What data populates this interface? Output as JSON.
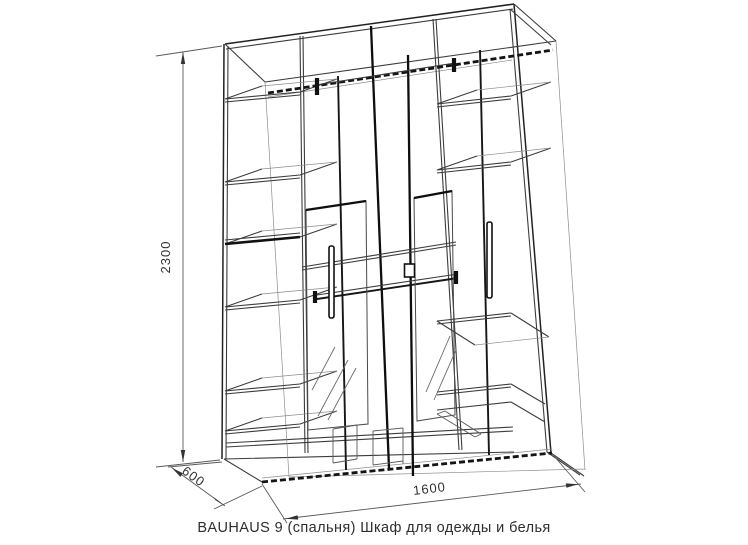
{
  "drawing": {
    "caption": "BAUHAUS 9 (спальня) Шкаф для одежды и белья",
    "dim_height": "2300",
    "dim_width": "1600",
    "dim_depth": "600"
  },
  "colors": {
    "background": "#ffffff",
    "ink": "#2e2e2e",
    "dimension_line": "#5a5a5a",
    "dimension_text": "#333333"
  }
}
